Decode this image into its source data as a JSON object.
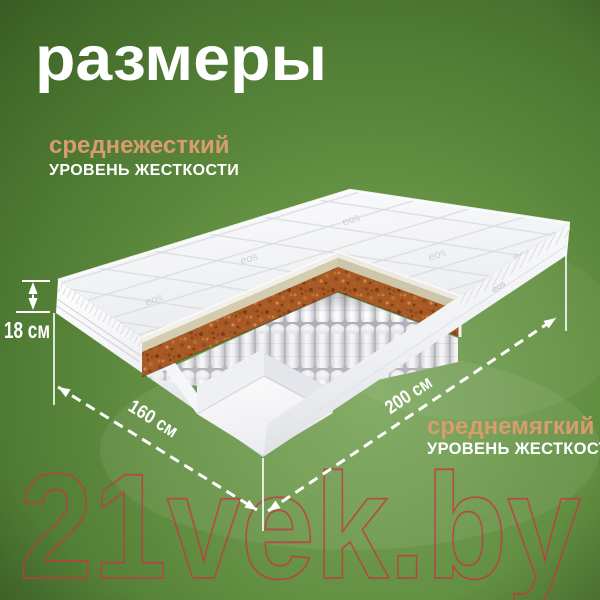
{
  "title": "размеры",
  "mattress": {
    "firmness_top": {
      "level": "среднежесткий",
      "caption": "УРОВЕНЬ ЖЕСТКОСТИ"
    },
    "firmness_bottom": {
      "level": "среднемягкий",
      "caption": "УРОВЕНЬ ЖЕСТКОСТИ"
    },
    "dimensions": {
      "height": "18 см",
      "width": "160 см",
      "length": "200 см"
    },
    "fabric_logo": "eos"
  },
  "watermark": "21vek.by",
  "colors": {
    "background_green": "#5d8a3e",
    "accent_tan": "#d89c6e",
    "coir_brown": "#a85a26",
    "watermark_red": "#c23a42",
    "text_white": "#ffffff"
  }
}
